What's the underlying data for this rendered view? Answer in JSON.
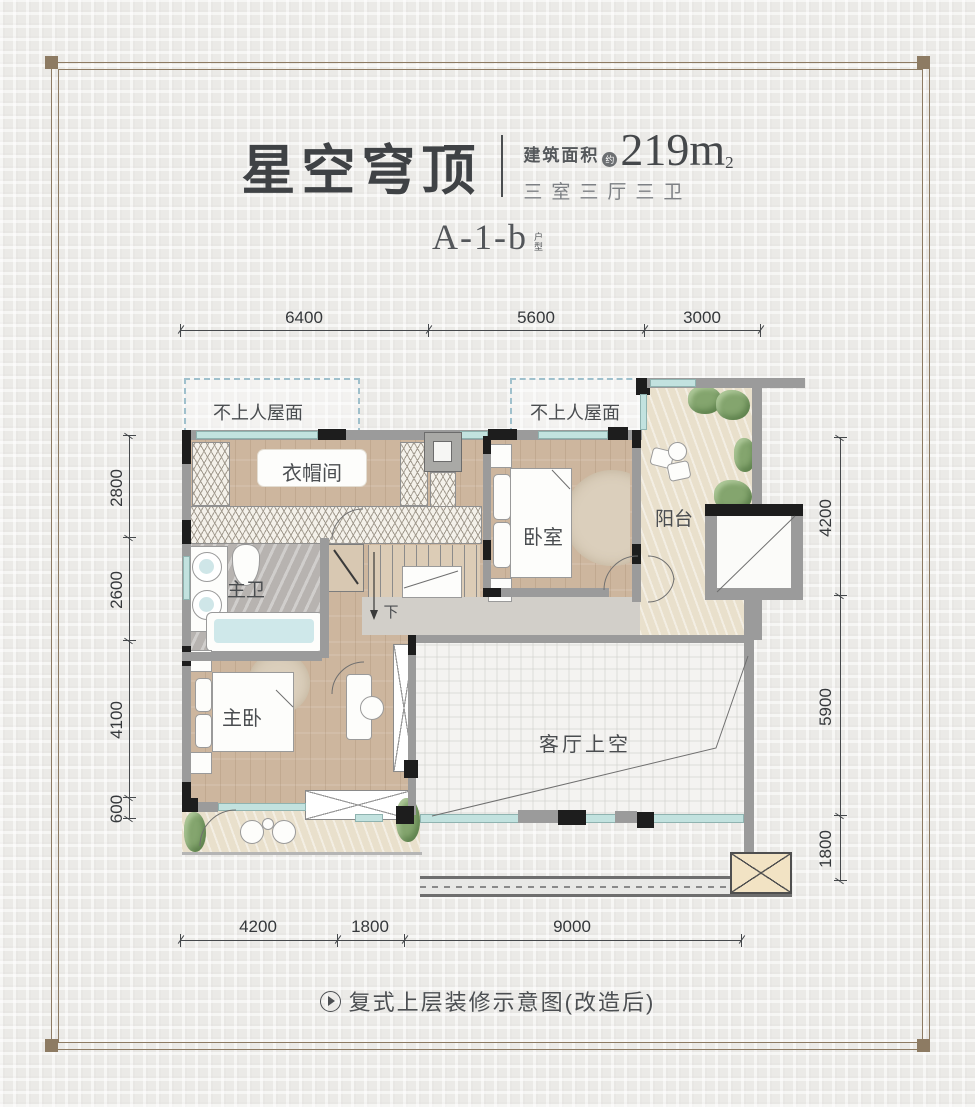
{
  "header": {
    "title": "星空穹顶",
    "area_prefix": "建筑面积",
    "area_circle": "约",
    "area_value": "219m",
    "area_exponent": "2",
    "spec": "三室三厅三卫",
    "unit_code": "A-1-b",
    "unit_suffix_top": "户",
    "unit_suffix_bottom": "型"
  },
  "plan": {
    "labels": {
      "roof_left": "不上人屋面",
      "roof_right": "不上人屋面",
      "cloakroom": "衣帽间",
      "bedroom": "卧室",
      "balcony": "阳台",
      "master_bath": "主卫",
      "master_bedroom": "主卧",
      "living_void": "客厅上空",
      "stair_down": "下"
    },
    "dimensions": {
      "top": [
        "6400",
        "5600",
        "3000"
      ],
      "left": [
        "2800",
        "2600",
        "4100",
        "600"
      ],
      "right": [
        "4200",
        "5900",
        "1800"
      ],
      "bottom": [
        "4200",
        "1800",
        "9000"
      ]
    }
  },
  "caption": {
    "text": "复式上层装修示意图(改造后)"
  },
  "colors": {
    "wood_floor": "#cdb69e",
    "stone_floor": "#e9e0cc",
    "bath_floor": "#b7b3b0",
    "void_floor": "#f4f3f1",
    "wall_dark": "#1d1d1d",
    "wall_gray": "#9b9b9b",
    "window_teal": "#c2e2df",
    "plant_green": "#84a56e",
    "frame_brown": "#8d7b63",
    "text_dark": "#3f4245"
  }
}
